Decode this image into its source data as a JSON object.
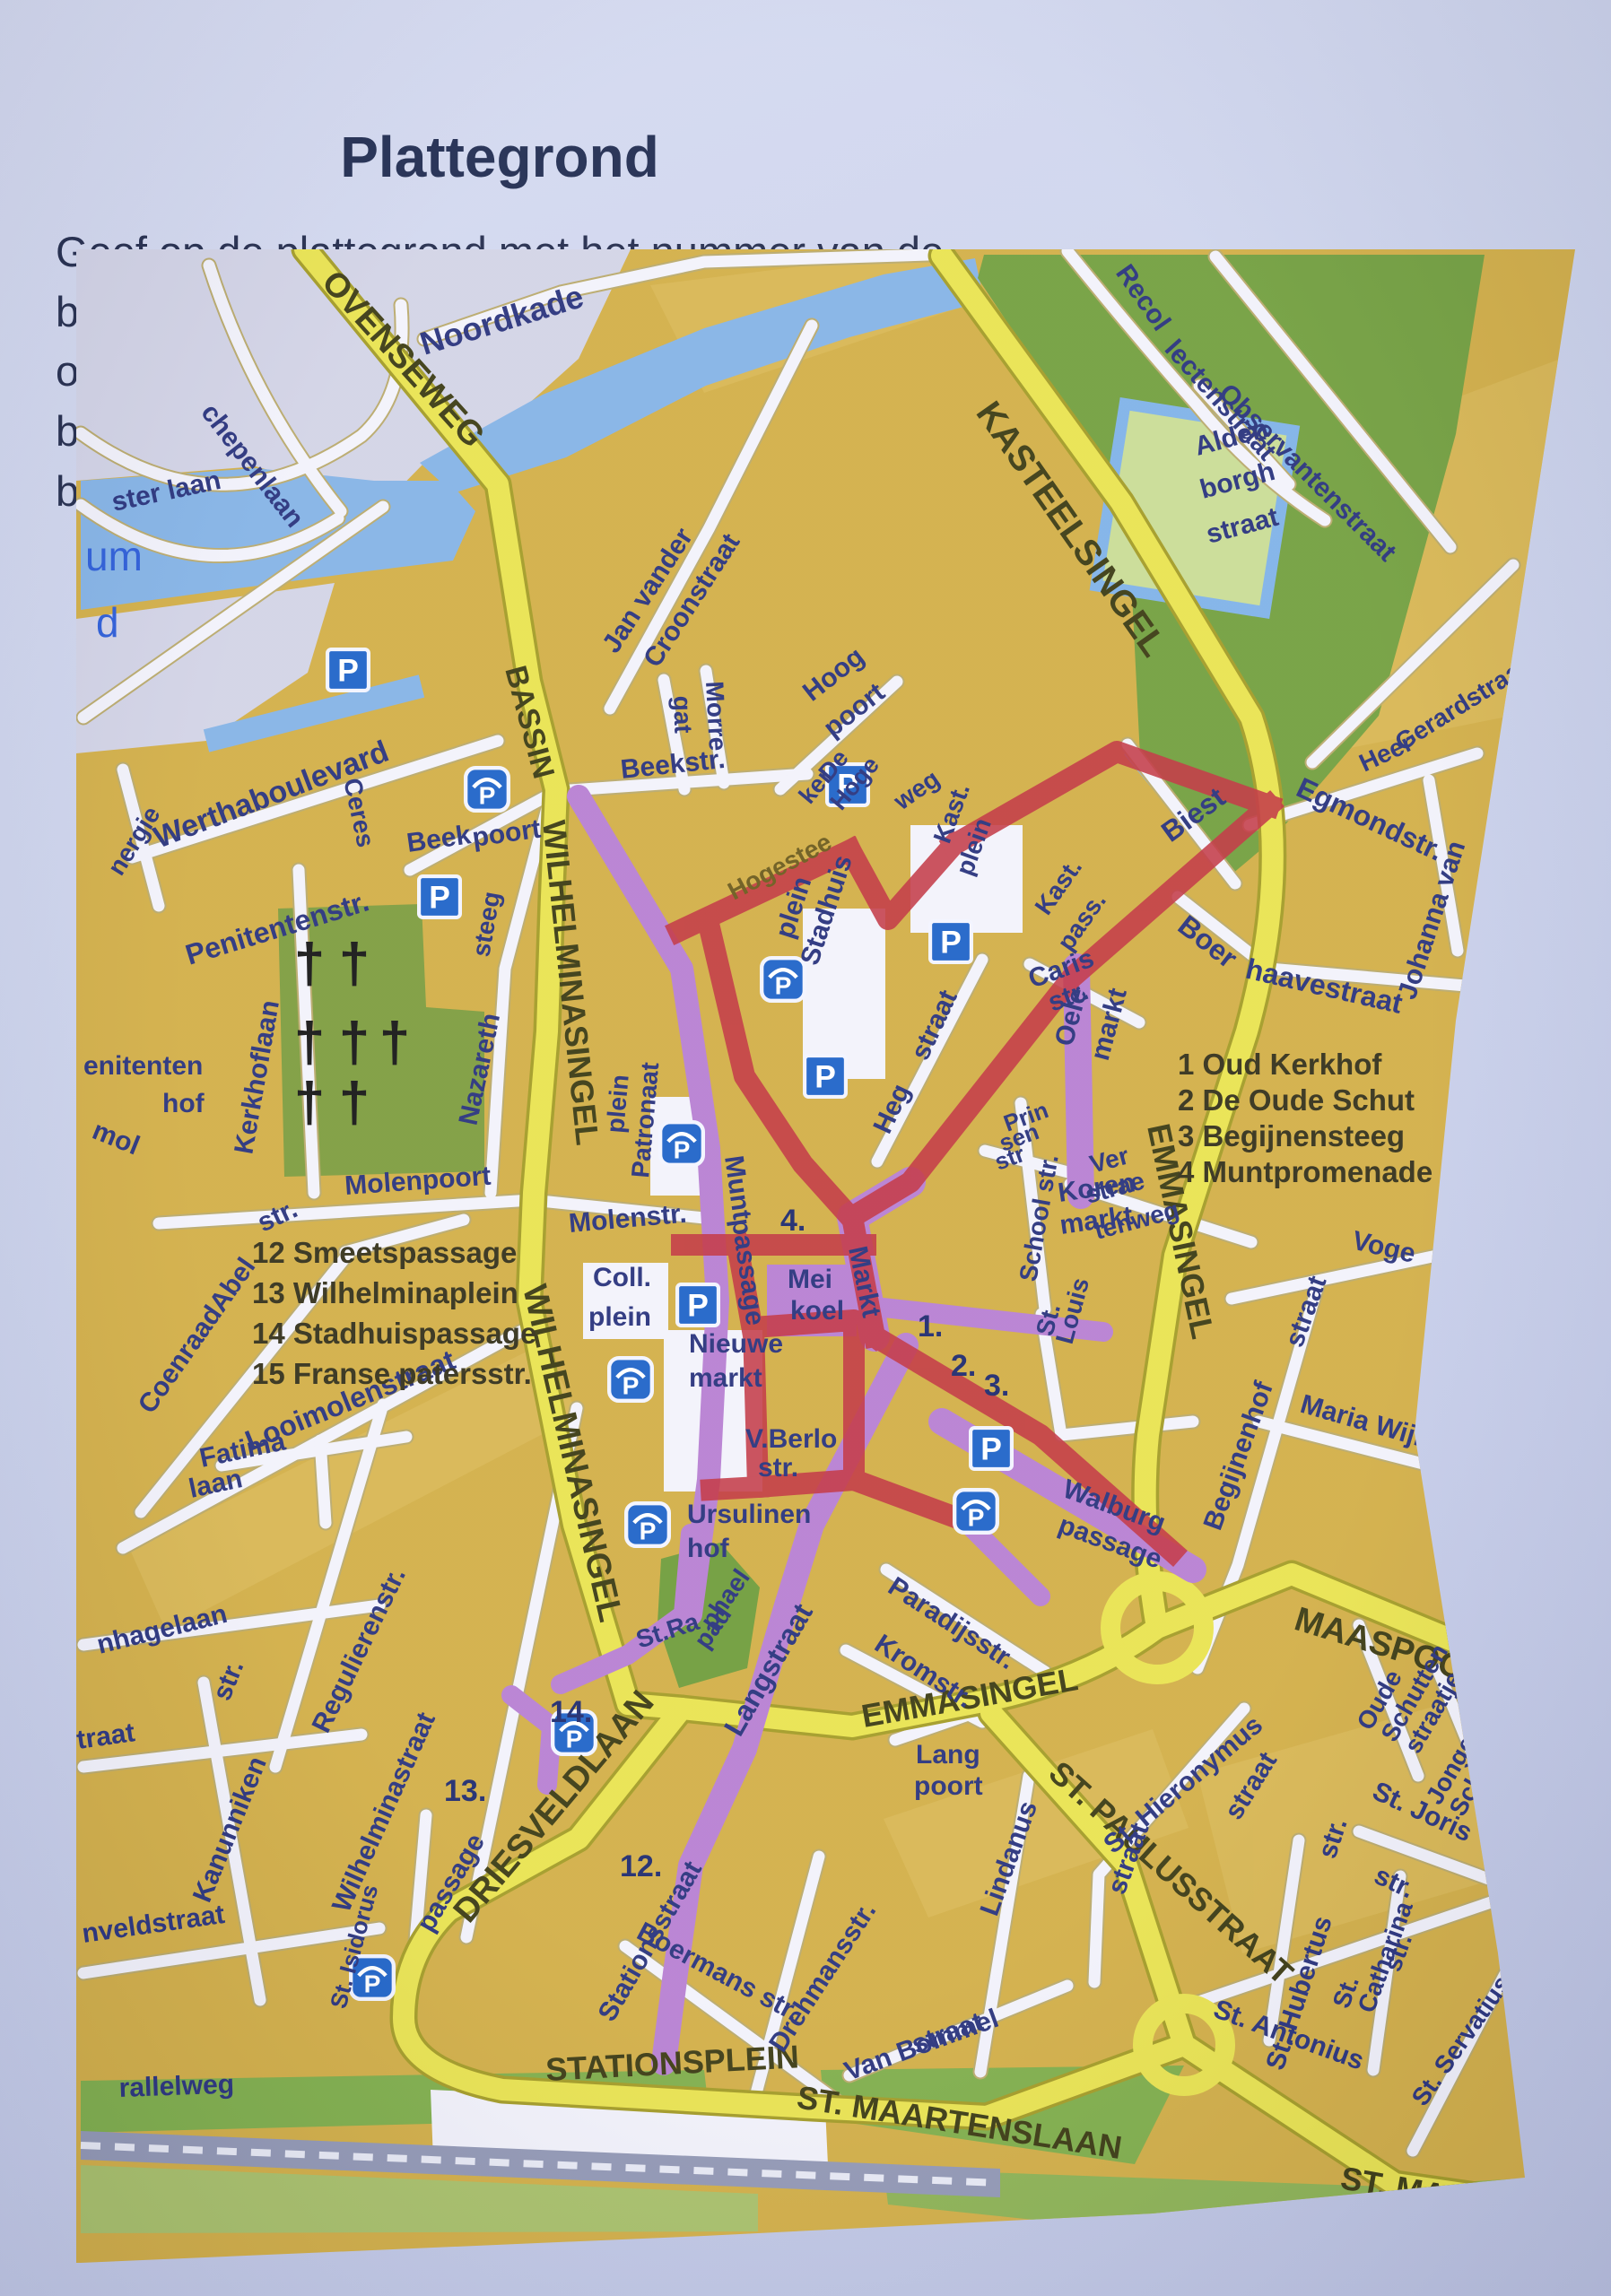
{
  "page": {
    "title": "Plattegrond",
    "instructions_line1": "Geef op de plattegrond met het nummer van de betreffende vraag aan",
    "instructions_line2": "op welke plek het voorwerp op de foto zich bevindt. De punten",
    "instructions_line3_before": "bevinden zich op de ",
    "instructions_line3_red": "rood",
    "instructions_line3_after": " gemarkeerde route."
  },
  "map": {
    "colors": {
      "route_red": "#c23240",
      "street_purple": "#b77fd2",
      "road_yellow": "#e9e34f",
      "water_blue": "#84b3e6",
      "park_green": "#75a040",
      "block_ochre": "#d2ae46",
      "label_navy": "#28327c",
      "parking_blue": "#1e63c8",
      "cross_glyph": "†"
    },
    "legend_right": [
      "1 Oud Kerkhof",
      "2 De Oude Schut",
      "3 Begijnensteeg",
      "4 Muntpromenade"
    ],
    "legend_left": [
      "12 Smeetspassage",
      "13 Wilhelminaplein",
      "14 Stadhuispassage",
      "15 Franse patersstr."
    ],
    "route_numbers": [
      [
        "4.",
        785,
        1094
      ],
      [
        "1.",
        938,
        1212
      ],
      [
        "2.",
        975,
        1256
      ],
      [
        "3.",
        1012,
        1278
      ],
      [
        "12.",
        606,
        1814
      ],
      [
        "13.",
        410,
        1730
      ],
      [
        "14.",
        528,
        1642
      ]
    ],
    "route_segments": [
      [
        672,
        760,
        863,
        670
      ],
      [
        863,
        670,
        905,
        747,
        978,
        664
      ],
      [
        978,
        664,
        1160,
        560,
        1330,
        620
      ],
      [
        1330,
        620,
        1110,
        812,
        930,
        1040,
        865,
        1079
      ],
      [
        705,
        752,
        745,
        922,
        810,
        1020,
        862,
        1078
      ],
      [
        675,
        1110,
        880,
        1110
      ],
      [
        865,
        1079,
        890,
        1212
      ],
      [
        890,
        1212,
        1075,
        1322,
        1222,
        1452
      ],
      [
        890,
        1212,
        867,
        1194,
        755,
        1202,
        760,
        1380,
        867,
        1372,
        867,
        1196
      ],
      [
        737,
        1110,
        753,
        1200
      ],
      [
        760,
        1380,
        708,
        1383
      ],
      [
        867,
        1372,
        975,
        1412
      ]
    ],
    "parking_standard": [
      [
        303,
        469
      ],
      [
        405,
        722
      ],
      [
        860,
        597
      ],
      [
        975,
        772
      ],
      [
        835,
        922
      ],
      [
        693,
        1177
      ],
      [
        1020,
        1337
      ]
    ],
    "parking_garage": [
      [
        458,
        602
      ],
      [
        788,
        814
      ],
      [
        675,
        997
      ],
      [
        618,
        1260
      ],
      [
        1003,
        1407
      ],
      [
        637,
        1422
      ],
      [
        555,
        1654
      ],
      [
        330,
        1927
      ]
    ],
    "cemetery_crosses": [
      [
        260,
        817
      ],
      [
        310,
        817
      ],
      [
        260,
        905
      ],
      [
        310,
        905
      ],
      [
        355,
        905
      ],
      [
        260,
        972
      ],
      [
        310,
        972
      ]
    ],
    "labels": [
      [
        "ster laan",
        42,
        292,
        -12,
        30
      ],
      [
        "chepenlaan",
        138,
        182,
        52,
        30
      ],
      [
        "um",
        10,
        358,
        0,
        46,
        "b"
      ],
      [
        "d",
        22,
        432,
        0,
        46,
        "b"
      ],
      [
        "Noordkade",
        388,
        118,
        -17,
        36
      ],
      [
        "OVENSEWEG",
        272,
        38,
        48,
        38,
        "r"
      ],
      [
        "BASSIN",
        478,
        468,
        75,
        34,
        "r"
      ],
      [
        "Jan vander",
        602,
        452,
        -57,
        30
      ],
      [
        "Croonstraat",
        648,
        468,
        -57,
        30
      ],
      [
        "Recol",
        1158,
        26,
        55,
        30
      ],
      [
        "lectenstraat",
        1212,
        112,
        48,
        30
      ],
      [
        "Observantenstraat",
        1272,
        162,
        45,
        30
      ],
      [
        "Alden",
        1250,
        230,
        -15,
        30
      ],
      [
        "borgh",
        1256,
        278,
        -15,
        30
      ],
      [
        "straat",
        1263,
        328,
        -15,
        30
      ],
      [
        "Heer",
        1436,
        583,
        -25,
        28
      ],
      [
        "Gerardstraat",
        1478,
        560,
        -32,
        28
      ],
      [
        "Egmondstr.",
        1358,
        608,
        25,
        32
      ],
      [
        "Johanna van",
        1492,
        838,
        -72,
        30
      ],
      [
        "Biest",
        1220,
        662,
        -36,
        32
      ],
      [
        "Boer",
        1226,
        758,
        38,
        32
      ],
      [
        "haavestraat",
        1302,
        812,
        13,
        32
      ],
      [
        "KASTEELSINGEL",
        1002,
        182,
        55,
        40,
        "r"
      ],
      [
        "EMMASINGEL",
        1194,
        978,
        78,
        36,
        "r"
      ],
      [
        "EMMASINGEL",
        878,
        1648,
        -10,
        36,
        "r"
      ],
      [
        "MAASPOORT",
        1356,
        1538,
        17,
        38,
        "r"
      ],
      [
        "ST. PAULUSSTRAAT",
        1082,
        1702,
        42,
        36,
        "r"
      ],
      [
        "ST. MAARTENSLAAN",
        802,
        2072,
        9,
        36,
        "r"
      ],
      [
        "ST. MAARTE",
        1408,
        2162,
        10,
        36,
        "r"
      ],
      [
        "STATIONSPLEIN",
        524,
        2042,
        -3,
        36,
        "r"
      ],
      [
        "DRIESVELDLAAN",
        438,
        1868,
        -50,
        38,
        "r"
      ],
      [
        "WILHELMINASINGEL",
        520,
        638,
        84,
        36,
        "r"
      ],
      [
        "WILHELMINASINGEL",
        498,
        1158,
        77,
        38,
        "r"
      ],
      [
        "Werthaboulevard",
        92,
        668,
        -21,
        34
      ],
      [
        "Penitentenstr.",
        126,
        798,
        -17,
        32
      ],
      [
        "nergie",
        50,
        700,
        -58,
        28
      ],
      [
        "Ceres",
        298,
        592,
        78,
        28
      ],
      [
        "Beek",
        370,
        672,
        -8,
        30
      ],
      [
        "poort",
        443,
        666,
        -8,
        30
      ],
      [
        "steeg",
        460,
        790,
        -80,
        28
      ],
      [
        "Nazareth",
        446,
        978,
        -78,
        30
      ],
      [
        "Kerkhoflaan",
        196,
        1010,
        -80,
        30
      ],
      [
        "enitenten",
        8,
        920,
        0,
        30
      ],
      [
        "hof",
        96,
        962,
        0,
        30
      ],
      [
        "mol",
        16,
        990,
        22,
        30
      ],
      [
        "Molenpoort",
        300,
        1054,
        -4,
        30
      ],
      [
        "str.",
        208,
        1096,
        -25,
        30
      ],
      [
        "CoenraadAbel",
        84,
        1300,
        -55,
        30
      ],
      [
        "Looimolenstraat",
        194,
        1340,
        -22,
        32
      ],
      [
        "Fatima",
        140,
        1358,
        -12,
        30
      ],
      [
        "laan",
        128,
        1392,
        -12,
        30
      ],
      [
        "nhagelaan",
        26,
        1566,
        -14,
        30
      ],
      [
        "traat",
        2,
        1672,
        -8,
        30
      ],
      [
        "Kanunniken",
        148,
        1845,
        -68,
        30
      ],
      [
        "str.",
        170,
        1620,
        -68,
        30
      ],
      [
        "nveldstraat",
        8,
        1888,
        -8,
        30
      ],
      [
        "Regulierenstr.",
        280,
        1656,
        -64,
        30
      ],
      [
        "Wilhelminastraat",
        303,
        1856,
        -66,
        30
      ],
      [
        "St. Isidorus",
        300,
        1963,
        -75,
        26
      ],
      [
        "passage",
        396,
        1878,
        -60,
        30
      ],
      [
        "rallelweg",
        48,
        2060,
        -2,
        30
      ],
      [
        "Beekstr.",
        608,
        590,
        -6,
        30
      ],
      [
        "Morre",
        702,
        482,
        87,
        28
      ],
      [
        "gat",
        666,
        498,
        88,
        28
      ],
      [
        "Hoog",
        820,
        505,
        -38,
        30
      ],
      [
        "poort",
        843,
        545,
        -38,
        30
      ],
      [
        "De",
        840,
        594,
        -50,
        27
      ],
      [
        "Hoge",
        853,
        627,
        -50,
        27
      ],
      [
        "ker",
        818,
        620,
        -50,
        27
      ],
      [
        "weg",
        920,
        626,
        -35,
        28
      ],
      [
        "Hogestee",
        733,
        726,
        -28,
        28,
        "o"
      ],
      [
        "Kast.",
        973,
        664,
        -70,
        28
      ],
      [
        "plein",
        998,
        700,
        -70,
        28
      ],
      [
        "Stadhuis",
        826,
        800,
        -72,
        30
      ],
      [
        "plein",
        798,
        770,
        -72,
        30
      ],
      [
        "Kast.",
        1083,
        744,
        -55,
        28
      ],
      [
        "pass.",
        1108,
        784,
        -55,
        28
      ],
      [
        "Caris",
        1066,
        824,
        -20,
        30
      ],
      [
        "str.",
        1088,
        850,
        -20,
        30
      ],
      [
        "Heg",
        906,
        988,
        -65,
        30
      ],
      [
        "straat",
        948,
        906,
        -65,
        30
      ],
      [
        "Oele",
        1110,
        890,
        -75,
        30
      ],
      [
        "markt",
        1150,
        906,
        -75,
        30
      ],
      [
        "Prin",
        1038,
        984,
        -20,
        26
      ],
      [
        "sen",
        1033,
        1006,
        -20,
        26
      ],
      [
        "str",
        1028,
        1027,
        -20,
        26
      ],
      [
        "School str.",
        1070,
        1152,
        -80,
        28
      ],
      [
        "Ver",
        1133,
        1030,
        -15,
        28
      ],
      [
        "strae",
        1128,
        1064,
        -15,
        28
      ],
      [
        "tenweg",
        1138,
        1104,
        -15,
        28
      ],
      [
        "Koren",
        1096,
        1062,
        -8,
        30
      ],
      [
        "markt",
        1098,
        1098,
        -8,
        30
      ],
      [
        "St.",
        1088,
        1213,
        -75,
        28
      ],
      [
        "Louis",
        1110,
        1222,
        -75,
        28
      ],
      [
        "Molenstr.",
        550,
        1096,
        -5,
        30
      ],
      [
        "Coll.",
        576,
        1156,
        0,
        30
      ],
      [
        "plein",
        571,
        1200,
        0,
        30
      ],
      [
        "Patronaat",
        638,
        1036,
        -85,
        28
      ],
      [
        "plein",
        610,
        986,
        -85,
        28
      ],
      [
        "Munt",
        723,
        1012,
        82,
        30
      ],
      [
        "passage",
        731,
        1082,
        82,
        30
      ],
      [
        "Mei",
        793,
        1158,
        0,
        30
      ],
      [
        "koel",
        796,
        1193,
        0,
        30
      ],
      [
        "Markt",
        861,
        1114,
        78,
        30
      ],
      [
        "Nieuwe",
        683,
        1230,
        0,
        30
      ],
      [
        "markt",
        683,
        1268,
        0,
        30
      ],
      [
        "V.Berlo",
        746,
        1336,
        0,
        30
      ],
      [
        "str.",
        760,
        1368,
        0,
        30
      ],
      [
        "Ursulinen",
        681,
        1420,
        0,
        30
      ],
      [
        "hof",
        681,
        1458,
        0,
        30
      ],
      [
        "Walburg",
        1098,
        1390,
        20,
        30
      ],
      [
        "passage",
        1093,
        1430,
        20,
        30
      ],
      [
        "Paradijsstr.",
        903,
        1496,
        33,
        30
      ],
      [
        "Kromstr.",
        888,
        1560,
        33,
        30
      ],
      [
        "Lang",
        936,
        1688,
        0,
        30
      ],
      [
        "poort",
        934,
        1723,
        0,
        30
      ],
      [
        "Langstraat",
        740,
        1660,
        -60,
        32
      ],
      [
        "Stationsstraat",
        598,
        1978,
        -60,
        30
      ],
      [
        "Boermans str.",
        623,
        1882,
        28,
        30
      ],
      [
        "Drehmansstr.",
        788,
        2012,
        -57,
        30
      ],
      [
        "Van Bommel",
        861,
        2042,
        -20,
        30
      ],
      [
        "straat",
        936,
        2012,
        -20,
        30
      ],
      [
        "St. Hieronymus",
        1156,
        1790,
        -40,
        30
      ],
      [
        "straat",
        1296,
        1753,
        -58,
        30
      ],
      [
        "Lindanus",
        1026,
        1860,
        -70,
        30
      ],
      [
        "straat",
        1168,
        1836,
        -70,
        30
      ],
      [
        "Oude",
        1443,
        1653,
        -60,
        28
      ],
      [
        "Schutten",
        1470,
        1666,
        -60,
        28
      ],
      [
        "straatje",
        1496,
        1679,
        -60,
        28
      ],
      [
        "Jonge",
        1520,
        1736,
        -60,
        28
      ],
      [
        "Schutten",
        1546,
        1749,
        -60,
        28
      ],
      [
        "str.",
        1573,
        1761,
        -60,
        28
      ],
      [
        "St. Joris",
        1443,
        1726,
        25,
        30
      ],
      [
        "str.",
        1445,
        1820,
        25,
        30
      ],
      [
        "St. Hubertus",
        1345,
        2032,
        -72,
        30
      ],
      [
        "str.",
        1403,
        1796,
        -72,
        30
      ],
      [
        "St.",
        1418,
        1963,
        -70,
        28
      ],
      [
        "Catharina",
        1446,
        1968,
        -70,
        28
      ],
      [
        "str.",
        1475,
        1922,
        -70,
        28
      ],
      [
        "St. Antonius",
        1266,
        1970,
        20,
        30
      ],
      [
        "St. Servatiusstr",
        1503,
        2072,
        -55,
        28
      ],
      [
        "Maria Wijng",
        1363,
        1296,
        16,
        30
      ],
      [
        "Begijnenhof",
        1275,
        1430,
        -70,
        30
      ],
      [
        "straat",
        1366,
        1226,
        -70,
        30
      ],
      [
        "Voge",
        1421,
        1114,
        13,
        30
      ],
      [
        "St.Ra",
        628,
        1560,
        -18,
        28
      ],
      [
        "phael",
        710,
        1540,
        -55,
        28
      ],
      [
        "pad",
        703,
        1562,
        -55,
        28
      ]
    ]
  }
}
